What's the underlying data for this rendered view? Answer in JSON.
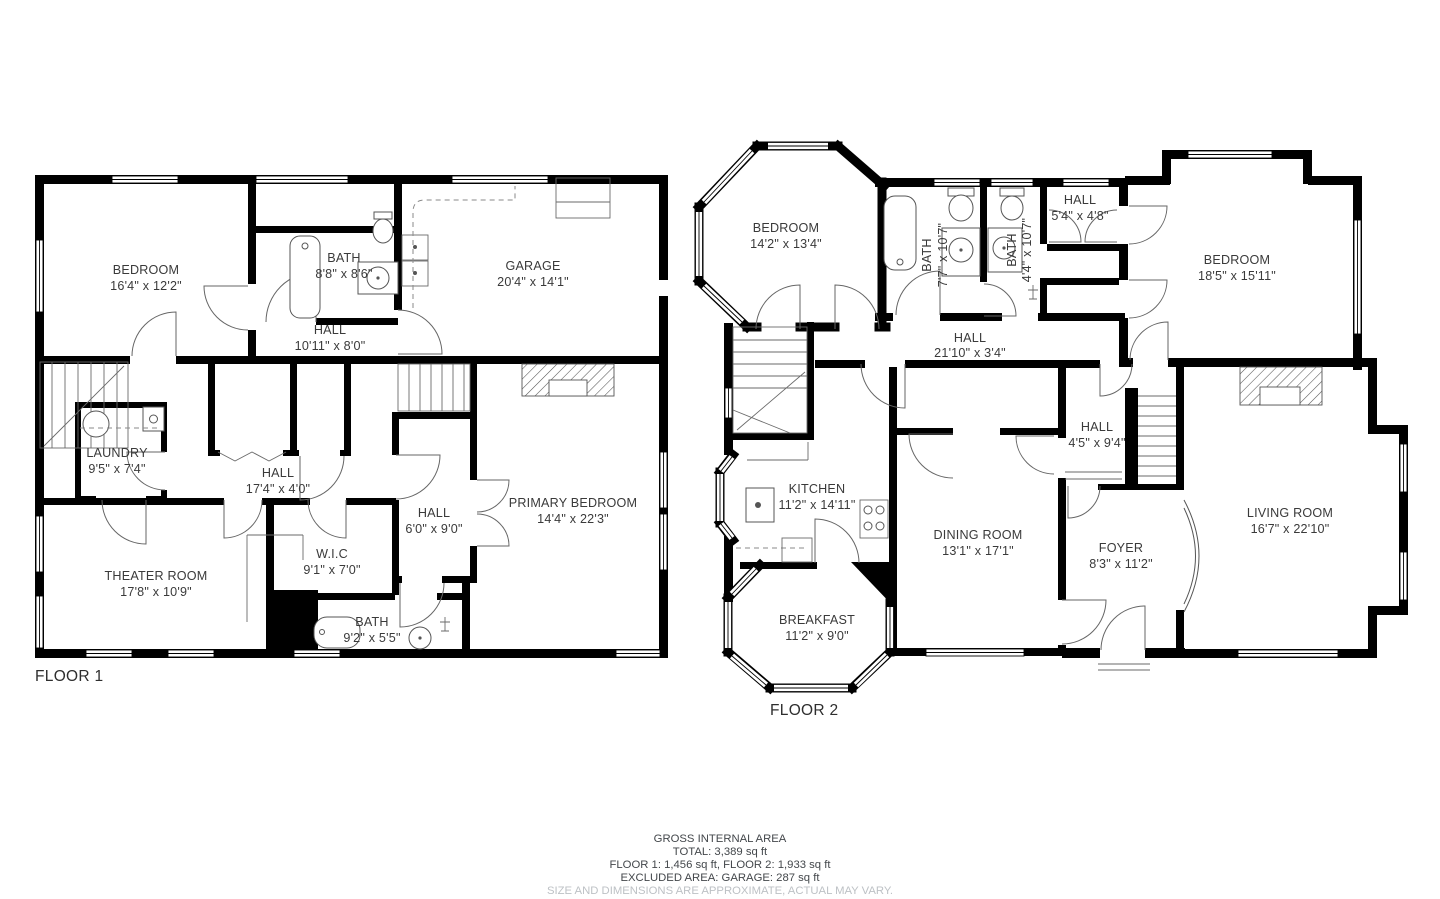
{
  "floor1": {
    "label": "FLOOR 1",
    "rooms": [
      {
        "name": "BEDROOM",
        "dims": "16'4\" x 12'2\""
      },
      {
        "name": "BATH",
        "dims": "8'8\" x 8'6\""
      },
      {
        "name": "GARAGE",
        "dims": "20'4\" x 14'1\""
      },
      {
        "name": "HALL",
        "dims": "10'11\" x 8'0\""
      },
      {
        "name": "LAUNDRY",
        "dims": "9'5\" x 7'4\""
      },
      {
        "name": "HALL",
        "dims": "17'4\" x 4'0\""
      },
      {
        "name": "HALL",
        "dims": "6'0\" x 9'0\""
      },
      {
        "name": "PRIMARY BEDROOM",
        "dims": "14'4\" x 22'3\""
      },
      {
        "name": "W.I.C",
        "dims": "9'1\" x 7'0\""
      },
      {
        "name": "THEATER ROOM",
        "dims": "17'8\" x 10'9\""
      },
      {
        "name": "BATH",
        "dims": "9'2\" x 5'5\""
      }
    ]
  },
  "floor2": {
    "label": "FLOOR 2",
    "rooms": [
      {
        "name": "BEDROOM",
        "dims": "14'2\" x 13'4\""
      },
      {
        "name": "BATH",
        "dims": "7'7\" x 10'7\""
      },
      {
        "name": "BATH",
        "dims": "4'4\" x 10'7\""
      },
      {
        "name": "HALL",
        "dims": "5'4\" x 4'8\""
      },
      {
        "name": "BEDROOM",
        "dims": "18'5\" x 15'11\""
      },
      {
        "name": "HALL",
        "dims": "21'10\" x 3'4\""
      },
      {
        "name": "KITCHEN",
        "dims": "11'2\" x 14'11\""
      },
      {
        "name": "DINING ROOM",
        "dims": "13'1\" x 17'1\""
      },
      {
        "name": "HALL",
        "dims": "4'5\" x 9'4\""
      },
      {
        "name": "FOYER",
        "dims": "8'3\" x 11'2\""
      },
      {
        "name": "LIVING ROOM",
        "dims": "16'7\" x 22'10\""
      },
      {
        "name": "BREAKFAST",
        "dims": "11'2\" x 9'0\""
      }
    ]
  },
  "footer": {
    "title": "GROSS INTERNAL AREA",
    "total": "TOTAL: 3,389 sq ft",
    "floors": "FLOOR 1: 1,456 sq ft, FLOOR 2: 1,933 sq ft",
    "excluded": "EXCLUDED AREA: GARAGE: 287 sq ft",
    "disclaimer": "SIZE AND DIMENSIONS ARE APPROXIMATE, ACTUAL MAY VARY."
  },
  "colors": {
    "wall": "#000000",
    "label_text": "#3a3a3a",
    "footer_text": "#43474b",
    "disclaimer_text": "#bdc1c5",
    "background": "#ffffff"
  }
}
